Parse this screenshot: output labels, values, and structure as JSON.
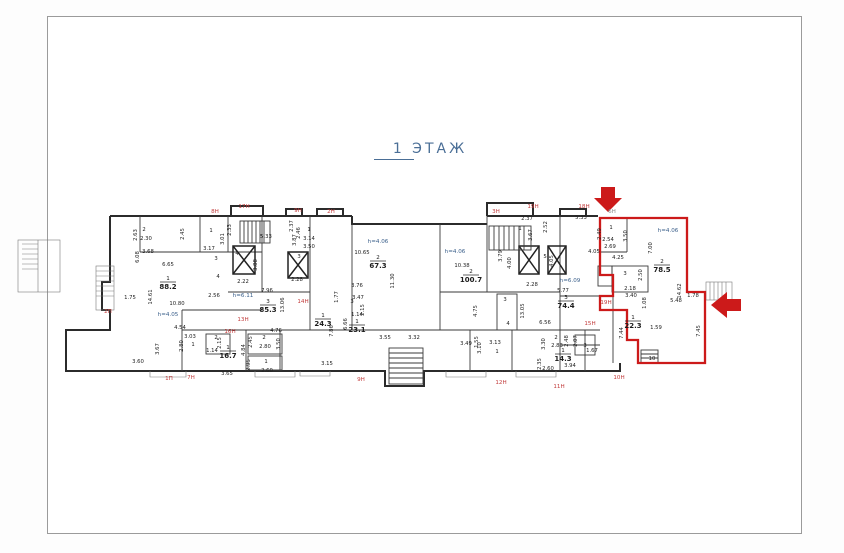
{
  "page": {
    "title": "1  ЭТАЖ",
    "title_color": "#4a6e96",
    "border_color": "#9b9b9b",
    "background": "#ffffff"
  },
  "plan": {
    "wall_color": "#2b2b2b",
    "highlight_color": "#cc1a1a",
    "height_label_color": "#3a5f8a",
    "unit_label_color": "#c23b3b",
    "rooms": [
      {
        "n": "1",
        "a": "88.2",
        "x": 168,
        "y": 283
      },
      {
        "n": "2",
        "a": "67.3",
        "x": 378,
        "y": 262
      },
      {
        "n": "3",
        "a": "85.3",
        "x": 268,
        "y": 306
      },
      {
        "n": "1",
        "a": "24.3",
        "x": 323,
        "y": 320
      },
      {
        "n": "1",
        "a": "23.1",
        "x": 357,
        "y": 326
      },
      {
        "n": "1",
        "a": "16.7",
        "x": 228,
        "y": 352
      },
      {
        "n": "2",
        "a": "100.7",
        "x": 471,
        "y": 276
      },
      {
        "n": "3",
        "a": "74.4",
        "x": 566,
        "y": 302
      },
      {
        "n": "1",
        "a": "22.3",
        "x": 633,
        "y": 322
      },
      {
        "n": "1",
        "a": "14.3",
        "x": 563,
        "y": 355
      },
      {
        "n": "2",
        "a": "78.5",
        "x": 662,
        "y": 266
      }
    ],
    "labels": [
      {
        "t": "8Н",
        "x": 215,
        "y": 213,
        "c": "r"
      },
      {
        "t": "17Н",
        "x": 244,
        "y": 208,
        "c": "r"
      },
      {
        "t": "9Н",
        "x": 298,
        "y": 212,
        "c": "r"
      },
      {
        "t": "2Н",
        "x": 331,
        "y": 213,
        "c": "r"
      },
      {
        "t": "3Н",
        "x": 496,
        "y": 213,
        "c": "r"
      },
      {
        "t": "19Н",
        "x": 533,
        "y": 208,
        "c": "r"
      },
      {
        "t": "18Н",
        "x": 584,
        "y": 208,
        "c": "r"
      },
      {
        "t": "6Н",
        "x": 612,
        "y": 213,
        "c": "g"
      },
      {
        "t": "1П",
        "x": 169,
        "y": 380,
        "c": "r"
      },
      {
        "t": "7Н",
        "x": 191,
        "y": 379,
        "c": "r"
      },
      {
        "t": "9Н",
        "x": 361,
        "y": 381,
        "c": "r"
      },
      {
        "t": "12Н",
        "x": 501,
        "y": 384,
        "c": "r"
      },
      {
        "t": "11Н",
        "x": 559,
        "y": 388,
        "c": "r"
      },
      {
        "t": "10Н",
        "x": 619,
        "y": 379,
        "c": "r"
      },
      {
        "t": "2П",
        "x": 108,
        "y": 313,
        "c": "r"
      },
      {
        "t": "13Н",
        "x": 243,
        "y": 321,
        "c": "r"
      },
      {
        "t": "14Н",
        "x": 303,
        "y": 303,
        "c": "r"
      },
      {
        "t": "16Н",
        "x": 230,
        "y": 333,
        "c": "r"
      },
      {
        "t": "19Н",
        "x": 606,
        "y": 304,
        "c": "r"
      },
      {
        "t": "15Н",
        "x": 590,
        "y": 325,
        "c": "r"
      },
      {
        "t": "h=4.05",
        "x": 168,
        "y": 316,
        "c": "b"
      },
      {
        "t": "h=6.11",
        "x": 243,
        "y": 297,
        "c": "b"
      },
      {
        "t": "h=4.06",
        "x": 378,
        "y": 243,
        "c": "b"
      },
      {
        "t": "h=4.06",
        "x": 455,
        "y": 253,
        "c": "b"
      },
      {
        "t": "h=6.09",
        "x": 570,
        "y": 282,
        "c": "b"
      },
      {
        "t": "h=4.06",
        "x": 668,
        "y": 232,
        "c": "b"
      },
      {
        "t": "2.63",
        "x": 137,
        "y": 235,
        "v": 1
      },
      {
        "t": "2",
        "x": 144,
        "y": 231
      },
      {
        "t": "2.30",
        "x": 146,
        "y": 240
      },
      {
        "t": "2.45",
        "x": 184,
        "y": 234,
        "v": 1
      },
      {
        "t": "3.68",
        "x": 148,
        "y": 253
      },
      {
        "t": "1",
        "x": 211,
        "y": 232
      },
      {
        "t": "3.17",
        "x": 209,
        "y": 250
      },
      {
        "t": "3.01",
        "x": 224,
        "y": 239,
        "v": 1
      },
      {
        "t": "2.33",
        "x": 231,
        "y": 230,
        "v": 1
      },
      {
        "t": "5.33",
        "x": 266,
        "y": 238
      },
      {
        "t": "3",
        "x": 216,
        "y": 260
      },
      {
        "t": "4",
        "x": 237,
        "y": 255
      },
      {
        "t": "3.88",
        "x": 257,
        "y": 265,
        "v": 1
      },
      {
        "t": "2.22",
        "x": 243,
        "y": 283
      },
      {
        "t": "4",
        "x": 218,
        "y": 278
      },
      {
        "t": "2.56",
        "x": 214,
        "y": 297
      },
      {
        "t": "6.65",
        "x": 168,
        "y": 266
      },
      {
        "t": "14.61",
        "x": 152,
        "y": 297,
        "v": 1
      },
      {
        "t": "10.80",
        "x": 177,
        "y": 305
      },
      {
        "t": "1.75",
        "x": 130,
        "y": 299
      },
      {
        "t": "6.08",
        "x": 139,
        "y": 257,
        "v": 1
      },
      {
        "t": "4.54",
        "x": 180,
        "y": 329
      },
      {
        "t": "3.03",
        "x": 190,
        "y": 338
      },
      {
        "t": "1",
        "x": 193,
        "y": 346
      },
      {
        "t": "2.80",
        "x": 183,
        "y": 346,
        "v": 1
      },
      {
        "t": "3.67",
        "x": 159,
        "y": 349,
        "v": 1
      },
      {
        "t": "3.60",
        "x": 138,
        "y": 363
      },
      {
        "t": "2",
        "x": 216,
        "y": 339
      },
      {
        "t": "2.15",
        "x": 221,
        "y": 343,
        "v": 1
      },
      {
        "t": "1.14",
        "x": 212,
        "y": 352
      },
      {
        "t": "3.65",
        "x": 227,
        "y": 375
      },
      {
        "t": "4.84",
        "x": 245,
        "y": 350,
        "v": 1
      },
      {
        "t": "2",
        "x": 264,
        "y": 339
      },
      {
        "t": "2.80",
        "x": 265,
        "y": 348
      },
      {
        "t": "2.45",
        "x": 252,
        "y": 342,
        "v": 1
      },
      {
        "t": "1",
        "x": 266,
        "y": 363
      },
      {
        "t": "2.60",
        "x": 267,
        "y": 372
      },
      {
        "t": "2.95",
        "x": 250,
        "y": 365,
        "v": 1
      },
      {
        "t": "3.50",
        "x": 280,
        "y": 344,
        "v": 1
      },
      {
        "t": "4.76",
        "x": 276,
        "y": 332
      },
      {
        "t": "7.96",
        "x": 267,
        "y": 292
      },
      {
        "t": "13.06",
        "x": 284,
        "y": 305,
        "v": 1
      },
      {
        "t": "2.46",
        "x": 300,
        "y": 233,
        "v": 1
      },
      {
        "t": "1",
        "x": 309,
        "y": 231
      },
      {
        "t": "3.14",
        "x": 309,
        "y": 240
      },
      {
        "t": "3.50",
        "x": 309,
        "y": 248
      },
      {
        "t": "2.37",
        "x": 293,
        "y": 226,
        "v": 1
      },
      {
        "t": "3.87",
        "x": 296,
        "y": 240,
        "v": 1
      },
      {
        "t": "2.28",
        "x": 297,
        "y": 281
      },
      {
        "t": "3",
        "x": 299,
        "y": 258
      },
      {
        "t": "10.65",
        "x": 362,
        "y": 254
      },
      {
        "t": "11.30",
        "x": 394,
        "y": 281,
        "v": 1
      },
      {
        "t": "3.76",
        "x": 357,
        "y": 287
      },
      {
        "t": "3.47",
        "x": 358,
        "y": 299
      },
      {
        "t": "6.66",
        "x": 347,
        "y": 324,
        "v": 1
      },
      {
        "t": "7.86",
        "x": 333,
        "y": 331,
        "v": 1
      },
      {
        "t": "1.77",
        "x": 338,
        "y": 297,
        "v": 1
      },
      {
        "t": "3",
        "x": 352,
        "y": 303
      },
      {
        "t": "2.15",
        "x": 364,
        "y": 310,
        "v": 1
      },
      {
        "t": "1.14",
        "x": 357,
        "y": 316
      },
      {
        "t": "3.15",
        "x": 327,
        "y": 365
      },
      {
        "t": "3.55",
        "x": 385,
        "y": 339
      },
      {
        "t": "3.32",
        "x": 414,
        "y": 339
      },
      {
        "t": "3.49",
        "x": 466,
        "y": 345
      },
      {
        "t": "1.55",
        "x": 478,
        "y": 342,
        "v": 1
      },
      {
        "t": "10.38",
        "x": 462,
        "y": 267
      },
      {
        "t": "2.37",
        "x": 527,
        "y": 220
      },
      {
        "t": "2.52",
        "x": 547,
        "y": 227,
        "v": 1
      },
      {
        "t": "3.67",
        "x": 532,
        "y": 235,
        "v": 1
      },
      {
        "t": "1",
        "x": 520,
        "y": 230
      },
      {
        "t": "5.33",
        "x": 581,
        "y": 219
      },
      {
        "t": "3.79",
        "x": 502,
        "y": 256,
        "v": 1
      },
      {
        "t": "4.00",
        "x": 511,
        "y": 263,
        "v": 1
      },
      {
        "t": "4.05",
        "x": 553,
        "y": 261,
        "v": 1
      },
      {
        "t": "2.28",
        "x": 532,
        "y": 286
      },
      {
        "t": "5",
        "x": 545,
        "y": 258
      },
      {
        "t": "5.77",
        "x": 563,
        "y": 292
      },
      {
        "t": "13.05",
        "x": 524,
        "y": 311,
        "v": 1
      },
      {
        "t": "6.56",
        "x": 545,
        "y": 324
      },
      {
        "t": "4.75",
        "x": 477,
        "y": 311,
        "v": 1
      },
      {
        "t": "3",
        "x": 505,
        "y": 301
      },
      {
        "t": "4",
        "x": 508,
        "y": 325
      },
      {
        "t": "3.13",
        "x": 495,
        "y": 344
      },
      {
        "t": "1",
        "x": 497,
        "y": 353
      },
      {
        "t": "3.10",
        "x": 481,
        "y": 348,
        "v": 1
      },
      {
        "t": "2",
        "x": 556,
        "y": 339
      },
      {
        "t": "2.83",
        "x": 557,
        "y": 347
      },
      {
        "t": "2.48",
        "x": 568,
        "y": 341,
        "v": 1
      },
      {
        "t": "3.30",
        "x": 545,
        "y": 344,
        "v": 1
      },
      {
        "t": "2.07",
        "x": 577,
        "y": 341,
        "v": 1
      },
      {
        "t": "2.60",
        "x": 548,
        "y": 370
      },
      {
        "t": "2.35",
        "x": 541,
        "y": 364,
        "v": 1
      },
      {
        "t": "3",
        "x": 585,
        "y": 347
      },
      {
        "t": "1.67",
        "x": 592,
        "y": 352
      },
      {
        "t": "3.94",
        "x": 570,
        "y": 367
      },
      {
        "t": "10",
        "x": 652,
        "y": 360
      },
      {
        "t": "7.44",
        "x": 623,
        "y": 333,
        "v": 1
      },
      {
        "t": "3.40",
        "x": 631,
        "y": 297
      },
      {
        "t": "2.18",
        "x": 630,
        "y": 290
      },
      {
        "t": "1.08",
        "x": 646,
        "y": 303,
        "v": 1
      },
      {
        "t": "1.59",
        "x": 656,
        "y": 329
      },
      {
        "t": "1.78",
        "x": 693,
        "y": 297
      },
      {
        "t": "7.45",
        "x": 700,
        "y": 331,
        "v": 1
      },
      {
        "t": "14.62",
        "x": 681,
        "y": 291,
        "v": 1
      },
      {
        "t": "5.48",
        "x": 676,
        "y": 302
      },
      {
        "t": "7.00",
        "x": 652,
        "y": 248,
        "v": 1
      },
      {
        "t": "4.25",
        "x": 618,
        "y": 259
      },
      {
        "t": "3",
        "x": 625,
        "y": 275
      },
      {
        "t": "2.50",
        "x": 642,
        "y": 275,
        "v": 1
      },
      {
        "t": "1",
        "x": 611,
        "y": 229
      },
      {
        "t": "2.49",
        "x": 601,
        "y": 234,
        "v": 1
      },
      {
        "t": "2.54",
        "x": 608,
        "y": 241
      },
      {
        "t": "2.69",
        "x": 610,
        "y": 248
      },
      {
        "t": "3.50",
        "x": 627,
        "y": 236,
        "v": 1
      },
      {
        "t": "4.05",
        "x": 594,
        "y": 253
      }
    ]
  }
}
